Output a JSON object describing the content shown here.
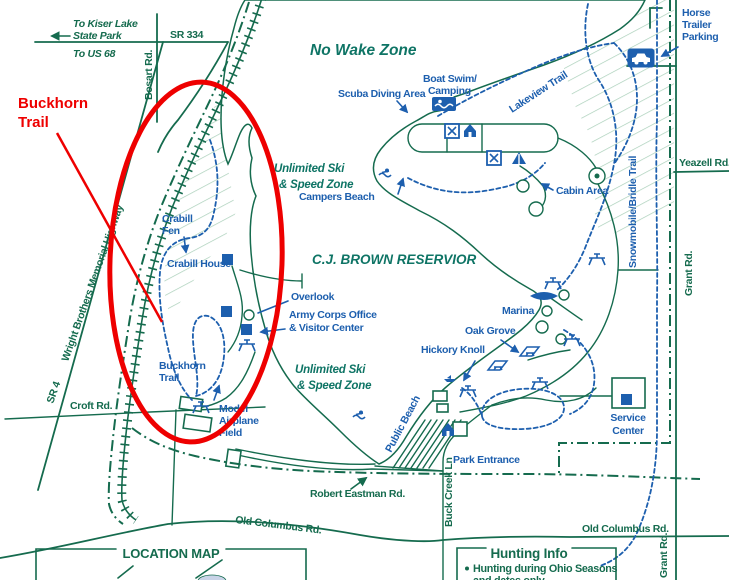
{
  "annotation": {
    "label_line1": "Buckhorn",
    "label_line2": "Trail",
    "color": "#ee0000"
  },
  "colors": {
    "map_green": "#156b4e",
    "facility_blue": "#1d5fae",
    "zone_teal": "#0e7465",
    "water_fill": "#c9d3e7",
    "water_tint": "#cdd6e9",
    "hatch_green": "#a9cfb9",
    "annotation_red": "#ee0000"
  },
  "zones": {
    "no_wake": "No Wake Zone",
    "ski_upper_line1": "Unlimited Ski",
    "ski_upper_line2": "& Speed Zone",
    "reservoir": "C.J. BROWN RESERVIOR",
    "ski_lower_line1": "Unlimited Ski",
    "ski_lower_line2": "& Speed Zone"
  },
  "roads": {
    "to_kiser_line1": "To Kiser Lake",
    "to_kiser_line2": "State Park",
    "to_us68": "To US 68",
    "sr334": "SR 334",
    "bosart": "Bosart Rd.",
    "sr4": "SR 4",
    "wright": "Wright Brothers Memorial Highway",
    "croft": "Croft Rd.",
    "yeazell": "Yeazell Rd.",
    "grant_upper": "Grant Rd.",
    "grant_lower": "Grant Rd.",
    "robert_eastman": "Robert Eastman Rd.",
    "old_columbus_left": "Old Columbus Rd.",
    "old_columbus_right": "Old Columbus Rd.",
    "buck_creek": "Buck Creek Ln"
  },
  "facilities": {
    "scuba": "Scuba Diving Area",
    "boat_swim_line1": "Boat Swim/",
    "boat_swim_line2": "Camping",
    "horse_line1": "Horse",
    "horse_line2": "Trailer",
    "horse_line3": "Parking",
    "lakeview": "Lakeview Trail",
    "cabin_area": "Cabin Area",
    "snowmobile": "Snowmobile/Bridle Trail",
    "campers_beach": "Campers Beach",
    "crabill_fen_line1": "Crabill",
    "crabill_fen_line2": "Fen",
    "crabill_house": "Crabill House",
    "overlook": "Overlook",
    "army_line1": "Army Corps Office",
    "army_line2": "& Visitor Center",
    "marina": "Marina",
    "oak_grove": "Oak Grove",
    "hickory_knoll": "Hickory Knoll",
    "buckhorn_line1": "Buckhorn",
    "buckhorn_line2": "Trail",
    "model_line1": "Model",
    "model_line2": "Airplane",
    "model_line3": "Field",
    "public_beach": "Public Beach",
    "park_entrance": "Park Entrance",
    "service_line1": "Service",
    "service_line2": "Center"
  },
  "footer": {
    "location_map_title": "LOCATION MAP",
    "hunting_title": "Hunting Info",
    "hunting_line1": "Hunting  during Ohio Seasons",
    "hunting_line2": "and dates only"
  }
}
